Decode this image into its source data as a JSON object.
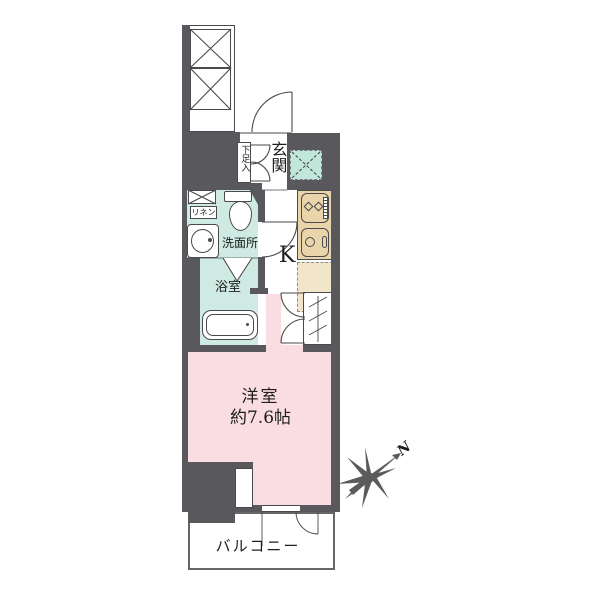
{
  "labels": {
    "genkan": "玄関",
    "shoe_storage": "下足入",
    "linen": "リネン",
    "washroom": "洗面所",
    "bathroom": "浴室",
    "kitchen": "K",
    "room_name": "洋室",
    "room_size": "約7.6帖",
    "balcony": "バルコニー",
    "north": "N"
  },
  "colors": {
    "wall": "#59585c",
    "line": "#4a4a4c",
    "wet_mint": "#cfeae3",
    "meter_teal": "#c0e7da",
    "room_pink": "#fadde3",
    "counter_beige": "#e9d5a9",
    "counter_beige_light": "#f1e6c9"
  }
}
